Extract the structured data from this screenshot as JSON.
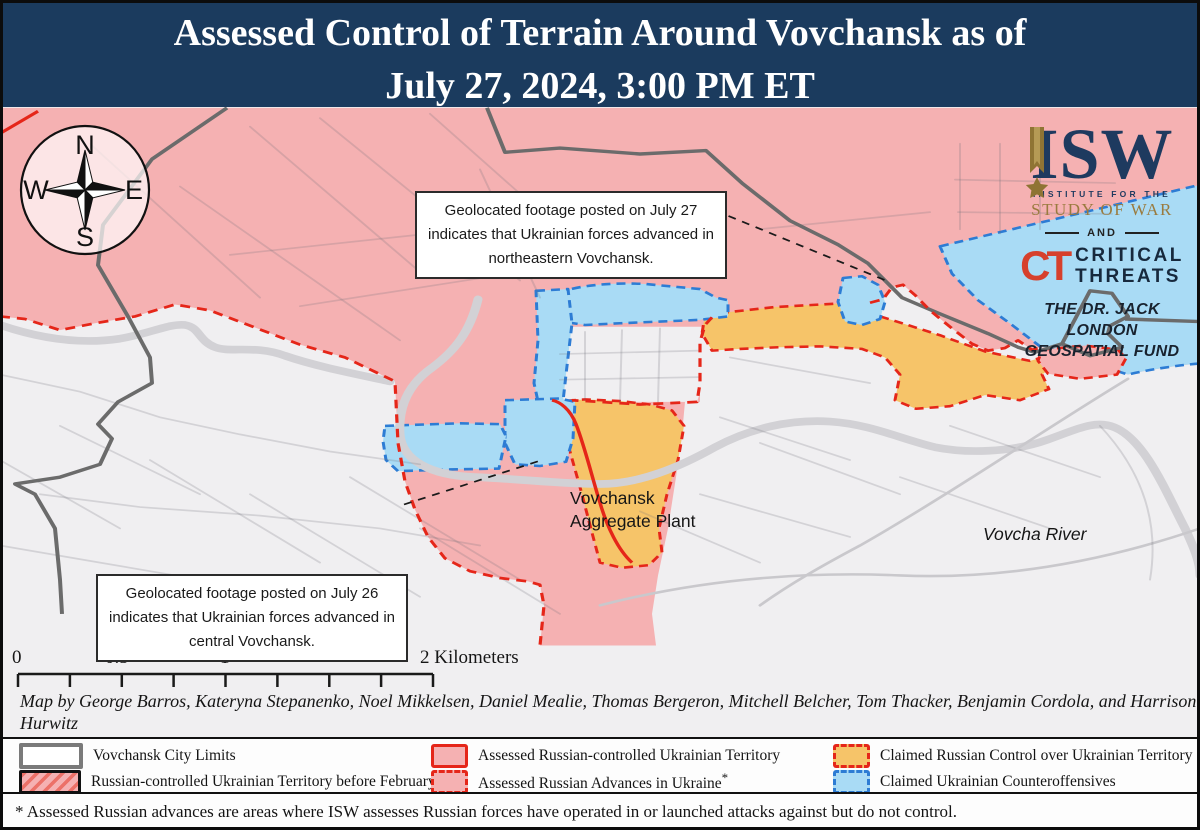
{
  "title": {
    "line1": "Assessed Control of Terrain Around Vovchansk as of",
    "line2": "July 27, 2024, 3:00 PM ET"
  },
  "logos": {
    "isw_acronym": "ISW",
    "isw_sub1": "INSTITUTE FOR THE",
    "isw_sub2": "STUDY OF WAR",
    "and_label": "AND",
    "ct_acronym": "CT",
    "ct_line1": "CRITICAL",
    "ct_line2": "THREATS",
    "fund_line1": "THE DR. JACK LONDON",
    "fund_line2": "GEOSPATIAL FUND"
  },
  "compass": {
    "n": "N",
    "e": "E",
    "s": "S",
    "w": "W"
  },
  "annotations": [
    {
      "text": "Geolocated footage posted on July 27 indicates that Ukrainian forces advanced in northeastern Vovchansk."
    },
    {
      "text": "Geolocated footage posted on July 26 indicates that Ukrainian forces advanced in central Vovchansk."
    }
  ],
  "map_labels": {
    "plant": {
      "line1": "Vovchansk",
      "line2": "Aggregate Plant"
    },
    "river": {
      "text": "Vovcha River"
    }
  },
  "scale_bar": {
    "tick0": "0",
    "tick05": "0.5",
    "tick1": "1",
    "tick2": "2 Kilometers"
  },
  "credits": {
    "line1": "Map by George Barros, Kateryna Stepanenko, Noel Mikkelsen, Daniel Mealie, Thomas Bergeron, Mitchell Belcher, Tom Thacker, Benjamin Cordola, and Harrison Hurwitz",
    "line2": "© 2024 Institute for the Study of War and AEI's Critical Threats Project"
  },
  "legend": {
    "items": [
      {
        "label": "Vovchansk City Limits"
      },
      {
        "label": "Russian-controlled Ukrainian Territory before February 24"
      },
      {
        "label": "Assessed Russian-controlled Ukrainian Territory"
      },
      {
        "label": "Assessed Russian Advances in Ukraine",
        "asterisk": "*"
      },
      {
        "label": "Claimed Russian Control over Ukrainian Territory"
      },
      {
        "label": "Claimed Ukrainian Counteroffensives"
      }
    ]
  },
  "footnote": "* Assessed Russian advances are areas where ISW assesses Russian forces have operated in or launched attacks against but do not control.",
  "colors": {
    "header-bg": "#1b3b5e",
    "pink": "#f5b1b2",
    "orange": "#f6c469",
    "blue": "#a9dbf5",
    "red": "#e52619",
    "blue-dash": "#2d7cd4",
    "city-line": "#6b6b6b",
    "map-bg": "#f0eff1",
    "navy": "#1e3a5f",
    "gold": "#9a7b3f",
    "ct-red": "#d6402c"
  }
}
